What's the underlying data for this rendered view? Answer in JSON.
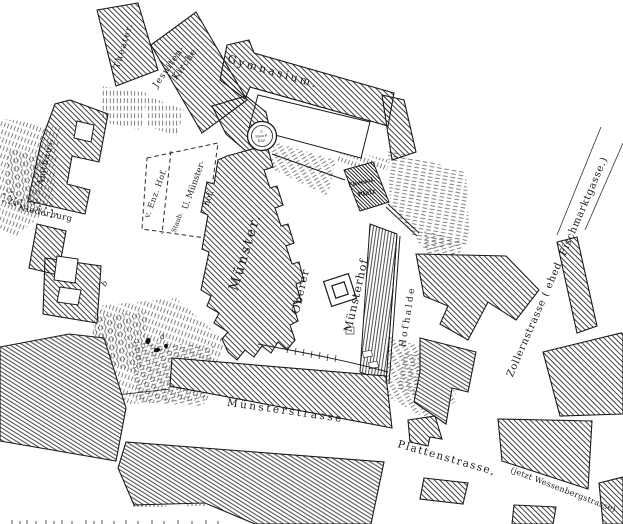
{
  "map": {
    "buildings": {
      "theater": "Theater.",
      "jesuiten_line1": "Jesuiten-",
      "jesuiten_line2": "Kirche.",
      "gymnasium": "Gymnasium.",
      "amthaus": "Amthaus.",
      "muenster": "Münster.",
      "pfalz_line1": "Ehemal.",
      "pfalz_line2": "Pfalz",
      "chapel_line1": "S.",
      "chapel_line2": "Maurit.",
      "chapel_line3": "Kap."
    },
    "areas": {
      "v_enz_hof": "v. Enz. Hof.",
      "staub": "Staub.",
      "u_muenster_line1": "U. Münster-",
      "u_muenster_line2": "hof.",
      "oberer": "Oberer",
      "muensterhof": "Münsterhof.",
      "zur": "Zur",
      "niederburg": "Niederburg"
    },
    "streets": {
      "muensterstrasse": "Münsterstrasse",
      "hofhalde": "Hofhalde",
      "plattenstrasse_part1": "Plattenstrasse,",
      "plattenstrasse_part2": "(jetzt Wessenbergstrasse)",
      "zollernstrasse": "Zollernstrasse ( ehed. Fischmarktgasse.)"
    },
    "markers": {
      "a": "a",
      "b": "b"
    },
    "colors": {
      "ink": "#1a1a1a",
      "paper": "#ffffff",
      "hachure": "#555555"
    }
  }
}
